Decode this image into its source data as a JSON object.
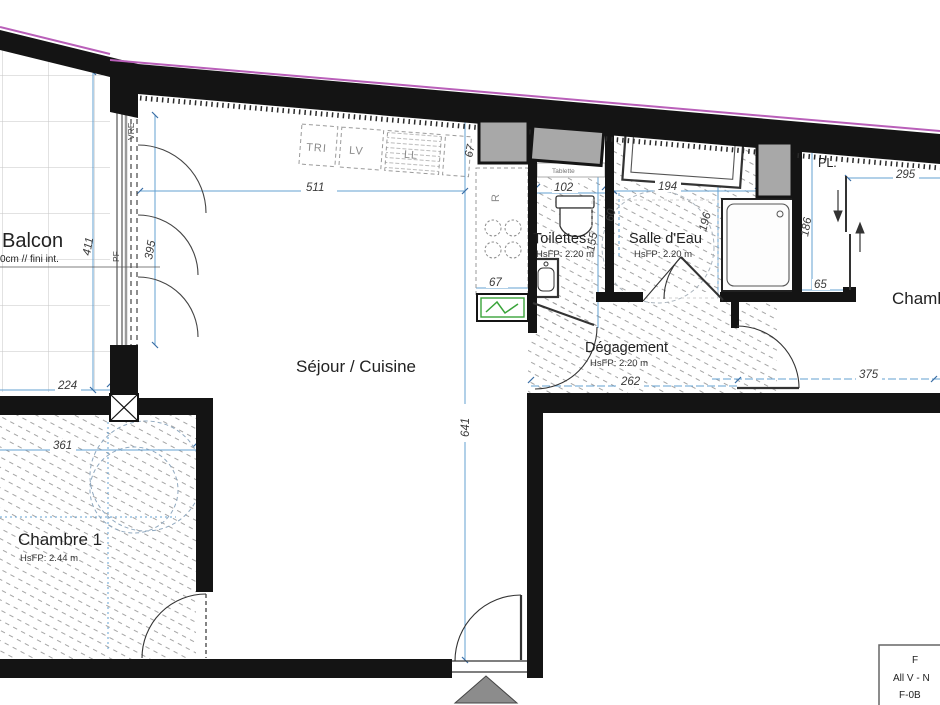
{
  "plan": {
    "rooms": {
      "balcon": {
        "label": "Balcon",
        "note": "0cm // fini int."
      },
      "sejour": {
        "label": "Séjour / Cuisine"
      },
      "toilettes": {
        "label": "Toilettes",
        "height": "HsFP: 2.20 m",
        "shelf": "Tablette"
      },
      "salle_deau": {
        "label": "Salle d'Eau",
        "height": "HsFP: 2.20 m"
      },
      "degagement": {
        "label": "Dégagement",
        "height": "HsFP: 2.20 m"
      },
      "chambre1": {
        "label": "Chambre 1",
        "height": "HsFP: 2.44 m"
      },
      "chambre2": {
        "label": "Chambre"
      },
      "placard": {
        "label": "PL."
      }
    },
    "kitchen": {
      "tri": "TRI",
      "lv": "LV",
      "ll": "LL",
      "fridge": "R"
    },
    "window_labels": {
      "pf": "PF",
      "vre": "VRE"
    },
    "dims": {
      "d511": "511",
      "d641": "641",
      "d67a": "67",
      "d67b": "67",
      "d102": "102",
      "d155": "155",
      "d194": "194",
      "d60": "60",
      "d196": "196",
      "d295": "295",
      "d186": "186",
      "d65": "65",
      "d262": "262",
      "d375": "375",
      "d361": "361",
      "d224": "224",
      "d411": "411",
      "d395": "395"
    },
    "title_block": {
      "line1": "F",
      "line2": "All V - N",
      "line3": "F-0B"
    },
    "colors": {
      "wall": "#141414",
      "dim_line": "#63a0d2",
      "property_line": "#b95fb9",
      "electric_green": "#3aa43a",
      "shaft_gray": "#a8a8a8",
      "arrow_gray": "#8c8c8c"
    }
  }
}
